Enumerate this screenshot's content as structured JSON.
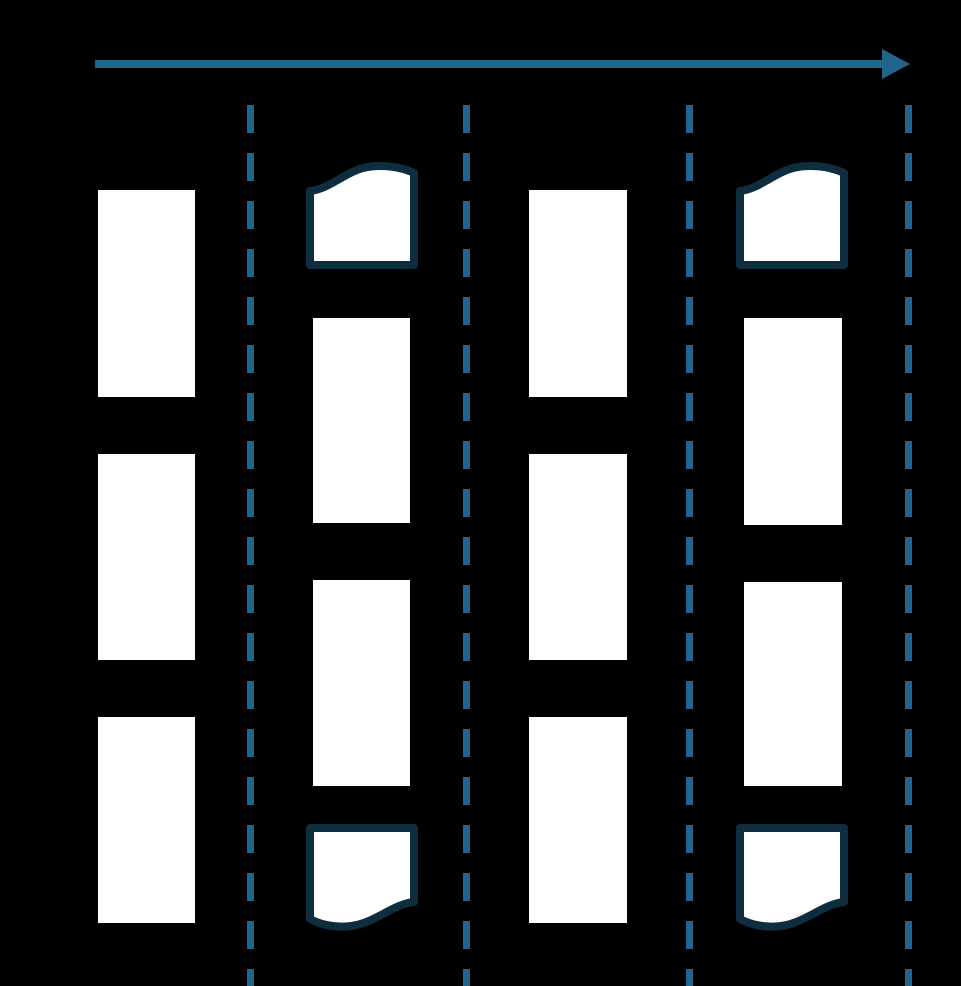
{
  "diagram": {
    "type": "fragmentation-flow-diagram",
    "arrow_label": "Processing order",
    "colors": {
      "accent": "#1f658c",
      "outline": "#0e2d3e",
      "box_fill": "#ffffff",
      "background": "#000000",
      "label_text": "#000000"
    },
    "columns": [
      {
        "name": "column-1",
        "boxes": [
          "block",
          "block",
          "block"
        ]
      },
      {
        "name": "column-2",
        "boxes": [
          "torn-top-block",
          "block",
          "block",
          "torn-bottom-block"
        ]
      },
      {
        "name": "column-3",
        "boxes": [
          "block",
          "block",
          "block"
        ]
      },
      {
        "name": "column-4",
        "boxes": [
          "torn-top-block",
          "block",
          "block",
          "torn-bottom-block"
        ]
      }
    ],
    "separators": {
      "style": "dashed",
      "count": 4
    }
  }
}
